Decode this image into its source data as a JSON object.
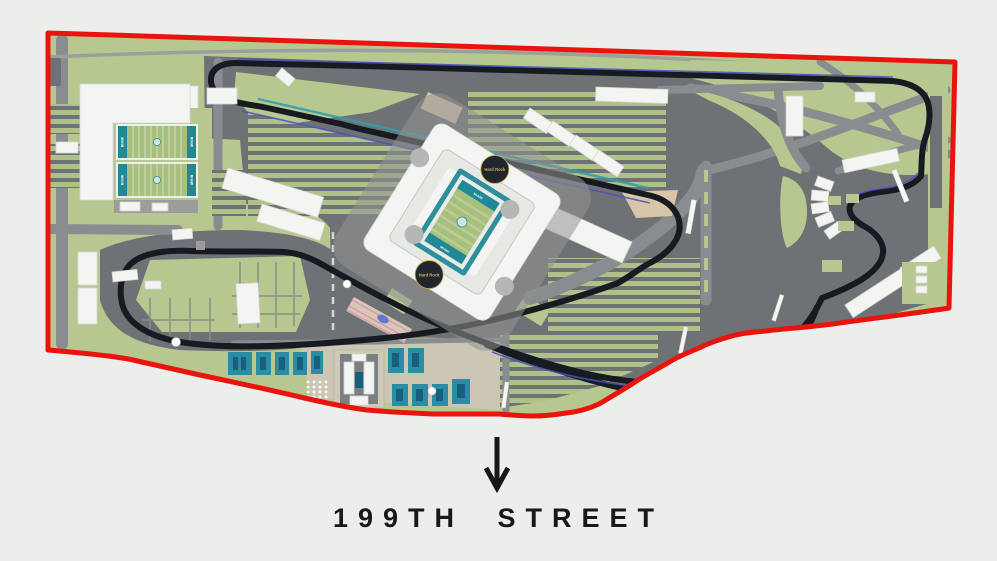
{
  "colors": {
    "background": "#eceeec",
    "boundary_red": "#e9140d",
    "site_green": "#b6c890",
    "stripe_green": "#aec189",
    "lot_gray": "#6f7275",
    "road_gray": "#8a8d8f",
    "road_light": "#9aa09d",
    "track_dark": "#171b21",
    "accent_blue": "#4752c0",
    "accent_teal": "#2f9fae",
    "building_white": "#f4f5f2",
    "teal_building": "#2a8da3",
    "teal_building_dark": "#175f7c",
    "tan": "#d9c5a8",
    "ground_tan": "#ccc6b4",
    "field_green": "#a9bf7e",
    "endzone_teal": "#1f8a96",
    "logo_navy": "#1f262e",
    "logo_gold": "#d4af5a",
    "text_dark": "#17181a"
  },
  "map": {
    "street_label": "199TH STREET",
    "stadium": {
      "logo_label": "Hard Rock",
      "field_label": "MIAMI"
    },
    "practice_fields": {
      "field_label": "MIAMI"
    }
  }
}
